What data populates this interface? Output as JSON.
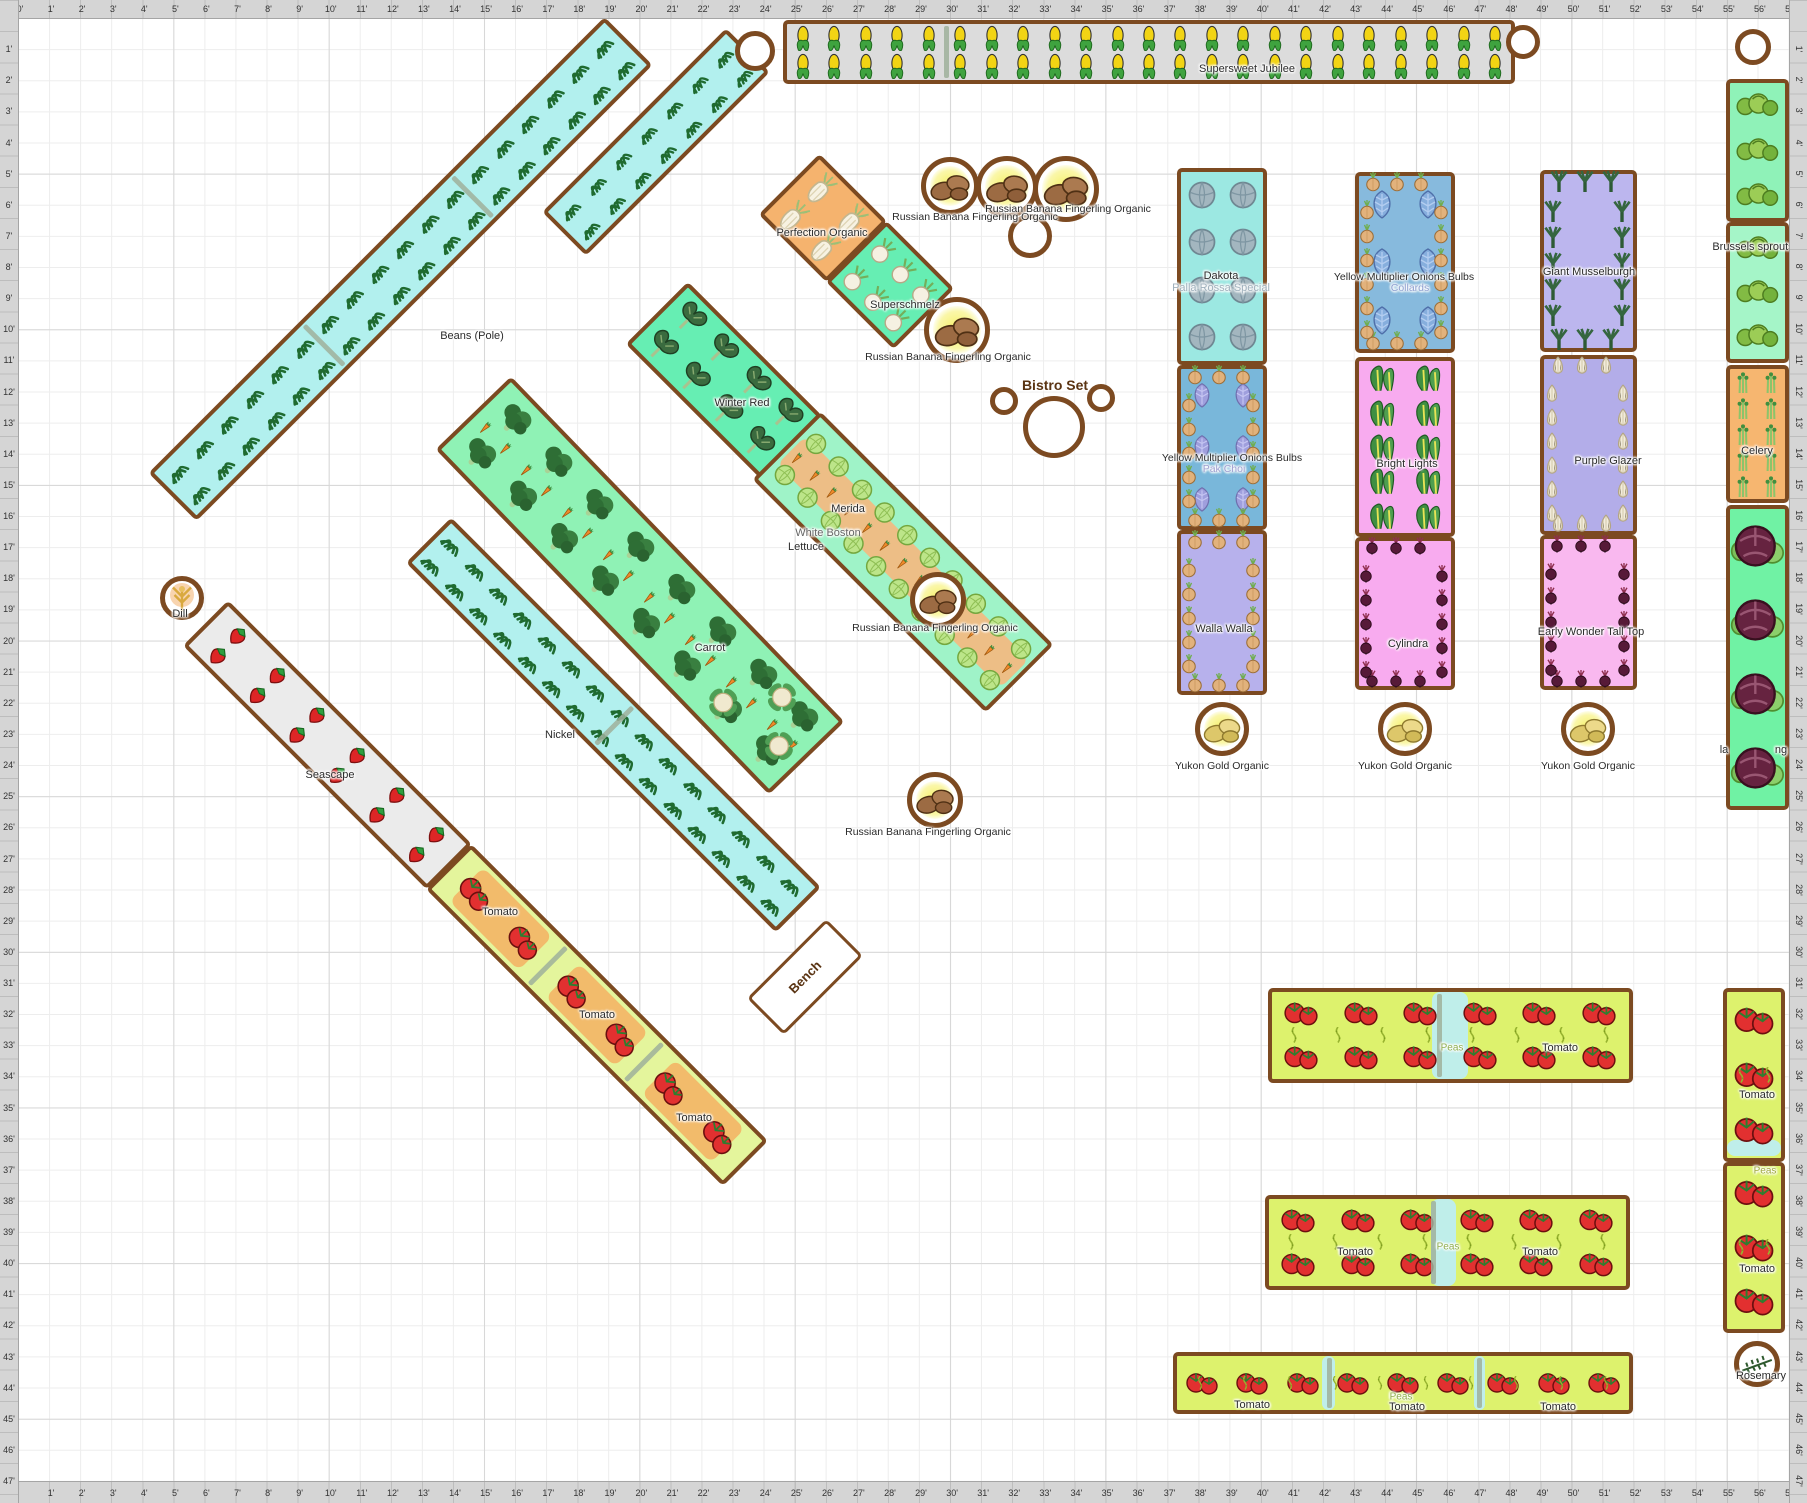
{
  "app": {
    "type": "garden-planner-plan"
  },
  "rulers": {
    "unit": "'",
    "h_min": 0,
    "h_max": 57,
    "v_min": 1,
    "v_max": 47,
    "px_per_foot_x": 31.07,
    "px_per_foot_y": 31.13
  },
  "colors": {
    "bed_border": "#7c4a21",
    "grid_minor": "#ededed",
    "grid_major": "#d7d7d7",
    "ruler_bg": "#d5d5d5",
    "cyan_bed": "#b2f0ee",
    "green_bed": "#66eeb3",
    "tomato_bed": "#ddf26d",
    "pink_bed": "#f8abef",
    "lavender_bed": "#b7b1ec",
    "orange_bed": "#f5b36e",
    "peas_patch": "#bfeeea",
    "label_ghost": "#9fb0bc"
  },
  "labels": [
    {
      "text": "Supersweet Jubilee",
      "x": 1247,
      "y": 69,
      "size": 11
    },
    {
      "text": "Beans (Pole)",
      "x": 472,
      "y": 336,
      "size": 11
    },
    {
      "text": "Perfection Organic",
      "x": 822,
      "y": 233,
      "size": 11
    },
    {
      "text": "Superschmelz",
      "x": 905,
      "y": 305,
      "size": 11
    },
    {
      "text": "Russian Banana Fingerling Organic",
      "x": 975,
      "y": 217,
      "size": 10.5
    },
    {
      "text": "Russian Banana Fingerling Organic",
      "x": 1068,
      "y": 209,
      "size": 10.5
    },
    {
      "text": "Russian Banana Fingerling Organic",
      "x": 948,
      "y": 357,
      "size": 10.5
    },
    {
      "text": "Russian Banana Fingerling Organic",
      "x": 935,
      "y": 628,
      "size": 10.5
    },
    {
      "text": "Russian Banana Fingerling Organic",
      "x": 928,
      "y": 832,
      "size": 10.5
    },
    {
      "text": "Dakota",
      "x": 1221,
      "y": 276,
      "size": 11
    },
    {
      "text": "Palla Rossa Special",
      "x": 1221,
      "y": 288,
      "size": 11,
      "color": "#9fb0bc"
    },
    {
      "text": "Yellow Multiplier Onions Bulbs",
      "x": 1232,
      "y": 458,
      "size": 10.5
    },
    {
      "text": "Pak Choi",
      "x": 1224,
      "y": 469,
      "size": 10.5,
      "color": "#9f9fd0"
    },
    {
      "text": "Walla Walla",
      "x": 1224,
      "y": 629,
      "size": 11
    },
    {
      "text": "Yukon Gold Organic",
      "x": 1222,
      "y": 766,
      "size": 10.5
    },
    {
      "text": "Yellow Multiplier Onions Bulbs",
      "x": 1404,
      "y": 277,
      "size": 10.5
    },
    {
      "text": "Collards",
      "x": 1410,
      "y": 288,
      "size": 10.5,
      "color": "#8fa0d0"
    },
    {
      "text": "Bright Lights",
      "x": 1407,
      "y": 464,
      "size": 11
    },
    {
      "text": "Cylindra",
      "x": 1408,
      "y": 644,
      "size": 11
    },
    {
      "text": "Yukon Gold Organic",
      "x": 1405,
      "y": 766,
      "size": 10.5
    },
    {
      "text": "Giant Musselburgh",
      "x": 1589,
      "y": 272,
      "size": 11
    },
    {
      "text": "Purple Glazer",
      "x": 1608,
      "y": 461,
      "size": 11
    },
    {
      "text": "Early Wonder Tall Top",
      "x": 1591,
      "y": 632,
      "size": 11
    },
    {
      "text": "Yukon Gold Organic",
      "x": 1588,
      "y": 766,
      "size": 10.5
    },
    {
      "text": "Brussels sprouts",
      "x": 1753,
      "y": 247,
      "size": 11
    },
    {
      "text": "Celery",
      "x": 1757,
      "y": 451,
      "size": 11
    },
    {
      "text": "la",
      "x": 1724,
      "y": 750,
      "size": 11
    },
    {
      "text": "ng",
      "x": 1781,
      "y": 750,
      "size": 11
    },
    {
      "text": "Winter Red",
      "x": 742,
      "y": 403,
      "size": 11
    },
    {
      "text": "Merida",
      "x": 848,
      "y": 509,
      "size": 11
    },
    {
      "text": "White Boston",
      "x": 828,
      "y": 533,
      "size": 11,
      "color": "#666666"
    },
    {
      "text": "Lettuce",
      "x": 806,
      "y": 547,
      "size": 11
    },
    {
      "text": "Carrot",
      "x": 710,
      "y": 648,
      "size": 11
    },
    {
      "text": "Nickel",
      "x": 560,
      "y": 735,
      "size": 11
    },
    {
      "text": "Seascape",
      "x": 330,
      "y": 775,
      "size": 11
    },
    {
      "text": "Dill",
      "x": 180,
      "y": 614,
      "size": 11
    },
    {
      "text": "Tomato",
      "x": 500,
      "y": 912,
      "size": 11
    },
    {
      "text": "Tomato",
      "x": 597,
      "y": 1015,
      "size": 11
    },
    {
      "text": "Tomato",
      "x": 694,
      "y": 1118,
      "size": 11
    },
    {
      "text": "Bench",
      "x": 805,
      "y": 977,
      "size": 13,
      "bold": true,
      "color": "#5a3413",
      "rot": -45
    },
    {
      "text": "Bistro Set",
      "x": 1055,
      "y": 385,
      "size": 14,
      "bold": true,
      "color": "#5a3413"
    },
    {
      "text": "Peas",
      "x": 1452,
      "y": 1048,
      "size": 10,
      "color": "#8fae4f"
    },
    {
      "text": "Tomato",
      "x": 1560,
      "y": 1048,
      "size": 11
    },
    {
      "text": "Tomato",
      "x": 1355,
      "y": 1252,
      "size": 11
    },
    {
      "text": "Peas",
      "x": 1448,
      "y": 1247,
      "size": 10,
      "color": "#8fae4f"
    },
    {
      "text": "Tomato",
      "x": 1540,
      "y": 1252,
      "size": 11
    },
    {
      "text": "Tomato",
      "x": 1252,
      "y": 1405,
      "size": 11
    },
    {
      "text": "Peas",
      "x": 1401,
      "y": 1397,
      "size": 10,
      "color": "#8fae4f"
    },
    {
      "text": "Tomato",
      "x": 1407,
      "y": 1407,
      "size": 11
    },
    {
      "text": "Tomato",
      "x": 1558,
      "y": 1407,
      "size": 11
    },
    {
      "text": "Tomato",
      "x": 1757,
      "y": 1095,
      "size": 11
    },
    {
      "text": "Peas",
      "x": 1765,
      "y": 1171,
      "size": 10,
      "color": "#a0a83f"
    },
    {
      "text": "Tomato",
      "x": 1757,
      "y": 1269,
      "size": 11
    },
    {
      "text": "Rosemary",
      "x": 1761,
      "y": 1376,
      "size": 11
    }
  ],
  "beds": [
    {
      "name": "bed-corn-supersweet-jubilee",
      "cx": 1149,
      "cy": 52,
      "len": 732,
      "wid": 64,
      "rot": 0,
      "bg": "#dcdcdc",
      "icons": {
        "t": "corn",
        "nx": 23,
        "ny": 2,
        "s": 26
      },
      "dividers": [
        0.22
      ]
    },
    {
      "name": "bed-beans-pole",
      "cx": 400,
      "cy": 269,
      "len": 645,
      "wid": 68,
      "rot": -45,
      "bg": "#b2f0ee",
      "icons": {
        "t": "beanTuft",
        "nx": 18,
        "ny": 2,
        "s": 26
      },
      "dividers": [
        0.33,
        0.66
      ]
    },
    {
      "name": "bed-beans-short",
      "cx": 656,
      "cy": 142,
      "len": 260,
      "wid": 62,
      "rot": -45,
      "bg": "#b2f0ee",
      "icons": {
        "t": "beanTuft",
        "nx": 7,
        "ny": 2,
        "s": 24
      }
    },
    {
      "name": "bed-beans-nickel",
      "cx": 613,
      "cy": 725,
      "len": 523,
      "wid": 64,
      "rot": 45,
      "bg": "#b2f0ee",
      "icons": {
        "t": "beanTuft",
        "nx": 15,
        "ny": 2,
        "s": 26
      },
      "dividers": [
        0.5
      ]
    },
    {
      "name": "bed-strawberry-seascape",
      "cx": 327,
      "cy": 745,
      "len": 345,
      "wid": 64,
      "rot": 45,
      "bg": "#ebebeb",
      "icons": {
        "t": "strawberry",
        "nx": 6,
        "ny": 2,
        "s": 24
      }
    },
    {
      "name": "bed-tomato-diagonal",
      "cx": 597,
      "cy": 1015,
      "len": 420,
      "wid": 64,
      "rot": 45,
      "bg": "#e4f59c",
      "patches": [
        {
          "fx": 0.17,
          "fy": 0.5,
          "fw": 0.24,
          "fh": 0.85,
          "c": "#f2bb6b"
        },
        {
          "fx": 0.5,
          "fy": 0.5,
          "fw": 0.24,
          "fh": 0.85,
          "c": "#f2bb6b"
        },
        {
          "fx": 0.83,
          "fy": 0.5,
          "fw": 0.24,
          "fh": 0.85,
          "c": "#f2bb6b"
        }
      ],
      "icons": {
        "t": "tomatoPair",
        "nx": 6,
        "ny": 1,
        "s": 38
      },
      "dividers": [
        0.33,
        0.66
      ]
    },
    {
      "name": "bed-kale-winter-red",
      "cx": 724,
      "cy": 380,
      "len": 190,
      "wid": 88,
      "rot": 45,
      "bg": "#66eeb3",
      "icons": {
        "t": "kale",
        "nx": 4,
        "ny": 2,
        "s": 34
      }
    },
    {
      "name": "bed-fennel-perfection",
      "cx": 823,
      "cy": 218,
      "len": 96,
      "wid": 86,
      "rot": 45,
      "bg": "#f5b36e",
      "icons": {
        "t": "fennel",
        "nx": 2,
        "ny": 2,
        "s": 34
      }
    },
    {
      "name": "bed-kohlrabi-superschmelz",
      "cx": 890,
      "cy": 285,
      "len": 96,
      "wid": 86,
      "rot": 45,
      "bg": "#66eeb3",
      "icons": {
        "t": "kohlrabi",
        "nx": 3,
        "ny": 2,
        "s": 26
      }
    },
    {
      "name": "bed-broccoli-carrot",
      "cx": 640,
      "cy": 585,
      "len": 480,
      "wid": 105,
      "rot": 46,
      "bg": "#8ff2b5",
      "icons": {
        "t": "broccoli",
        "nx": 8,
        "ny": 2,
        "s": 36
      },
      "icons2": {
        "t": "carrot",
        "nx": 16,
        "ny": 1,
        "s": 18
      },
      "extras": [
        {
          "t": "cauliflower",
          "fx": 0.88,
          "fy": 0.25,
          "s": 30
        },
        {
          "t": "cauliflower",
          "fx": 0.95,
          "fy": 0.62,
          "s": 30
        },
        {
          "t": "cauliflower",
          "fx": 0.8,
          "fy": 0.72,
          "s": 30
        }
      ]
    },
    {
      "name": "bed-lettuce-carrot",
      "cx": 903,
      "cy": 562,
      "len": 330,
      "wid": 96,
      "rot": 45,
      "bg": "#9ff3c8",
      "patches": [
        {
          "fx": 0.5,
          "fy": 0.5,
          "fw": 0.98,
          "fh": 0.45,
          "c": "#edbe86"
        }
      ],
      "icons": {
        "t": "lettuce",
        "nx": 10,
        "ny": 2,
        "s": 22
      },
      "icons2": {
        "t": "carrot",
        "nx": 13,
        "ny": 1,
        "s": 17
      }
    },
    {
      "name": "bed-radicchio-dakota",
      "cx": 1222,
      "cy": 266,
      "len": 90,
      "wid": 197,
      "rot": 0,
      "bg": "#9ce8e2",
      "icons": {
        "t": "radicchio",
        "nx": 2,
        "ny": 4,
        "s": 30
      }
    },
    {
      "name": "bed-onion-yellow-multiplier-1",
      "cx": 1222,
      "cy": 447,
      "len": 90,
      "wid": 165,
      "rot": 0,
      "bg": "#79b7da",
      "perimeter": {
        "t": "onion",
        "step": 24,
        "s": 20
      },
      "icons": {
        "t": "purpleLeaf",
        "nx": 2,
        "ny": 3,
        "s": 26
      }
    },
    {
      "name": "bed-onion-walla-walla",
      "cx": 1222,
      "cy": 612,
      "len": 90,
      "wid": 165,
      "rot": 0,
      "bg": "#b7b1ec",
      "perimeter": {
        "t": "onion",
        "step": 24,
        "s": 20
      }
    },
    {
      "name": "bed-onion-yellow-multiplier-2",
      "cx": 1405,
      "cy": 262,
      "len": 100,
      "wid": 181,
      "rot": 0,
      "bg": "#87badd",
      "perimeter": {
        "t": "onion",
        "step": 24,
        "s": 20
      },
      "icons": {
        "t": "collard",
        "nx": 2,
        "ny": 3,
        "s": 30
      }
    },
    {
      "name": "bed-chard-bright-lights",
      "cx": 1405,
      "cy": 447,
      "len": 100,
      "wid": 180,
      "rot": 0,
      "bg": "#f8abef",
      "icons": {
        "t": "chard",
        "nx": 2,
        "ny": 5,
        "s": 30
      }
    },
    {
      "name": "bed-beet-cylindra",
      "cx": 1405,
      "cy": 613,
      "len": 100,
      "wid": 153,
      "rot": 0,
      "bg": "#f8abef",
      "perimeter": {
        "t": "beet",
        "step": 24,
        "s": 18
      }
    },
    {
      "name": "bed-leek-giant-musselburgh",
      "cx": 1588,
      "cy": 261,
      "len": 97,
      "wid": 182,
      "rot": 0,
      "bg": "#bcb6ee",
      "perimeter": {
        "t": "leek",
        "step": 26,
        "s": 22
      }
    },
    {
      "name": "bed-garlic-purple-glazer",
      "cx": 1588,
      "cy": 445,
      "len": 97,
      "wid": 180,
      "rot": 0,
      "bg": "#b3ade9",
      "perimeter": {
        "t": "garlic",
        "step": 24,
        "s": 20
      }
    },
    {
      "name": "bed-beet-early-wonder",
      "cx": 1588,
      "cy": 612,
      "len": 97,
      "wid": 155,
      "rot": 0,
      "bg": "#f9b8ef",
      "perimeter": {
        "t": "beet",
        "step": 24,
        "s": 18
      }
    },
    {
      "name": "bed-brussels-sprouts-1",
      "cx": 1757,
      "cy": 150,
      "len": 63,
      "wid": 143,
      "rot": 0,
      "bg": "#8ff2b8",
      "icons": {
        "t": "brussels",
        "nx": 1,
        "ny": 3,
        "s": 44
      }
    },
    {
      "name": "bed-brussels-sprouts-2",
      "cx": 1757,
      "cy": 292,
      "len": 63,
      "wid": 141,
      "rot": 0,
      "bg": "#a5f5c8",
      "icons": {
        "t": "brussels",
        "nx": 1,
        "ny": 3,
        "s": 44
      }
    },
    {
      "name": "bed-celery",
      "cx": 1757,
      "cy": 434,
      "len": 63,
      "wid": 138,
      "rot": 0,
      "bg": "#f6b670",
      "icons": {
        "t": "celery",
        "nx": 2,
        "ny": 5,
        "s": 22
      }
    },
    {
      "name": "bed-cabbage-red",
      "cx": 1757,
      "cy": 657,
      "len": 63,
      "wid": 305,
      "rot": 0,
      "bg": "#70f2a4",
      "icons": {
        "t": "redCabbage",
        "nx": 1,
        "ny": 4,
        "s": 54
      }
    },
    {
      "name": "bed-tomato-right-1",
      "cx": 1754,
      "cy": 1075,
      "len": 62,
      "wid": 174,
      "rot": 0,
      "bg": "#ddf26d",
      "patches": [
        {
          "fx": 0.5,
          "fy": 0.94,
          "fw": 1,
          "fh": 0.1,
          "c": "#bfeeea"
        }
      ],
      "icons": {
        "t": "tomatoPair",
        "nx": 1,
        "ny": 3,
        "s": 42
      },
      "icons2": {
        "t": "peaVine",
        "nx": 2,
        "ny": 4,
        "s": 16
      }
    },
    {
      "name": "bed-tomato-right-2",
      "cx": 1754,
      "cy": 1247,
      "len": 62,
      "wid": 171,
      "rot": 0,
      "bg": "#ddf26d",
      "icons": {
        "t": "tomatoPair",
        "nx": 1,
        "ny": 3,
        "s": 42
      },
      "icons2": {
        "t": "peaVine",
        "nx": 2,
        "ny": 4,
        "s": 16
      }
    },
    {
      "name": "bed-tomato-peas-h1",
      "cx": 1450,
      "cy": 1035,
      "len": 365,
      "wid": 95,
      "rot": 0,
      "bg": "#ddf26d",
      "patches": [
        {
          "fx": 0.5,
          "fy": 0.5,
          "fw": 0.1,
          "fh": 1,
          "c": "#bfeeea"
        }
      ],
      "icons": {
        "t": "tomatoPair",
        "nx": 6,
        "ny": 2,
        "s": 36
      },
      "icons2": {
        "t": "peaVine",
        "nx": 8,
        "ny": 2,
        "s": 16
      },
      "dividers": [
        0.47
      ]
    },
    {
      "name": "bed-tomato-peas-h2",
      "cx": 1447,
      "cy": 1242,
      "len": 365,
      "wid": 95,
      "rot": 0,
      "bg": "#ddf26d",
      "patches": [
        {
          "fx": 0.49,
          "fy": 0.5,
          "fw": 0.07,
          "fh": 1,
          "c": "#bfeeea"
        }
      ],
      "icons": {
        "t": "tomatoPair",
        "nx": 6,
        "ny": 2,
        "s": 36
      },
      "icons2": {
        "t": "peaVine",
        "nx": 8,
        "ny": 2,
        "s": 16
      },
      "dividers": [
        0.46
      ]
    },
    {
      "name": "bed-tomato-peas-h3",
      "cx": 1403,
      "cy": 1383,
      "len": 460,
      "wid": 62,
      "rot": 0,
      "bg": "#ddf26d",
      "patches": [
        {
          "fx": 0.335,
          "fy": 0.5,
          "fw": 0.03,
          "fh": 1,
          "c": "#bfeeea"
        },
        {
          "fx": 0.67,
          "fy": 0.5,
          "fw": 0.025,
          "fh": 1,
          "c": "#bfeeea"
        }
      ],
      "icons": {
        "t": "tomatoPair",
        "nx": 9,
        "ny": 1,
        "s": 34
      },
      "icons2": {
        "t": "peaVine",
        "nx": 10,
        "ny": 1,
        "s": 14
      },
      "dividers": [
        0.337,
        0.669
      ]
    },
    {
      "name": "bench",
      "cx": 805,
      "cy": 977,
      "len": 112,
      "wid": 52,
      "rot": -45,
      "bg": "#ffffff",
      "bw": 3
    }
  ],
  "circles": [
    {
      "name": "planter-circle",
      "x": 755,
      "y": 51,
      "r": 20
    },
    {
      "name": "planter-circle",
      "x": 1523,
      "y": 42,
      "r": 17
    },
    {
      "name": "planter-circle",
      "x": 1753,
      "y": 47,
      "r": 18
    },
    {
      "name": "potato-russian-banana",
      "x": 950,
      "y": 186,
      "r": 29,
      "icon": "potato",
      "glow": true
    },
    {
      "name": "potato-russian-banana",
      "x": 1007,
      "y": 187,
      "r": 31,
      "icon": "potato",
      "glow": true
    },
    {
      "name": "potato-russian-banana",
      "x": 1066,
      "y": 189,
      "r": 33,
      "icon": "potato",
      "glow": true
    },
    {
      "name": "planter-circle",
      "x": 1030,
      "y": 236,
      "r": 22
    },
    {
      "name": "potato-russian-banana",
      "x": 957,
      "y": 330,
      "r": 33,
      "icon": "potato",
      "glow": true
    },
    {
      "name": "potato-russian-banana",
      "x": 938,
      "y": 600,
      "r": 28,
      "icon": "potato",
      "glow": true
    },
    {
      "name": "potato-russian-banana",
      "x": 935,
      "y": 800,
      "r": 28,
      "icon": "potato",
      "glow": true
    },
    {
      "name": "bistro-chair",
      "x": 1004,
      "y": 401,
      "r": 14
    },
    {
      "name": "bistro-table",
      "x": 1054,
      "y": 427,
      "r": 31
    },
    {
      "name": "bistro-chair",
      "x": 1101,
      "y": 398,
      "r": 14
    },
    {
      "name": "herb-dill",
      "x": 182,
      "y": 598,
      "r": 22,
      "icon": "dill"
    },
    {
      "name": "potato-yukon-gold",
      "x": 1222,
      "y": 729,
      "r": 27,
      "icon": "potatoYellow",
      "glow": true
    },
    {
      "name": "potato-yukon-gold",
      "x": 1405,
      "y": 729,
      "r": 27,
      "icon": "potatoYellow",
      "glow": true
    },
    {
      "name": "potato-yukon-gold",
      "x": 1588,
      "y": 729,
      "r": 27,
      "icon": "potatoYellow",
      "glow": true
    },
    {
      "name": "herb-rosemary",
      "x": 1757,
      "y": 1364,
      "r": 23,
      "icon": "rosemary"
    }
  ]
}
